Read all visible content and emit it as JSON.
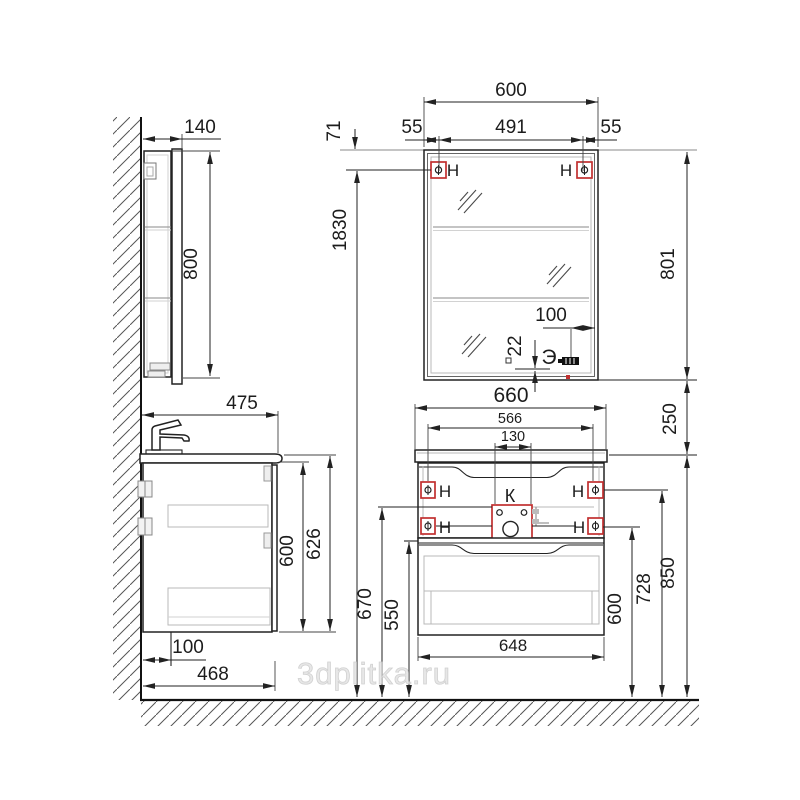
{
  "watermark": "3dplitka.ru",
  "colors": {
    "accent_red": "#c13030",
    "line": "#222222"
  },
  "marks": {
    "hanger": "Н",
    "drain_box": "К",
    "socket": "Э"
  },
  "dims": {
    "cabinet_depth": "140",
    "cabinet_height": "800",
    "mount_total_height": "1830",
    "mirror_top_to_mount": "71",
    "mirror_width": "600",
    "mirror_mount_span": "491",
    "mirror_mount_left": "55",
    "mirror_mount_right": "55",
    "mirror_height": "801",
    "socket_from_edge": "100",
    "socket_from_bottom": "22",
    "mirror_to_vanity_gap": "250",
    "vanity_width": "660",
    "vanity_mount_span": "566",
    "drain_box_width": "130",
    "vanity_top_height": "850",
    "upper_mount_height": "728",
    "supply_height": "670",
    "lower_mount_height": "600",
    "drain_height": "550",
    "vanity_body_width": "648",
    "vanity_depth": "475",
    "vanity_body_height": "600",
    "vanity_total_height": "626",
    "drain_from_wall": "100",
    "vanity_body_depth": "468"
  }
}
